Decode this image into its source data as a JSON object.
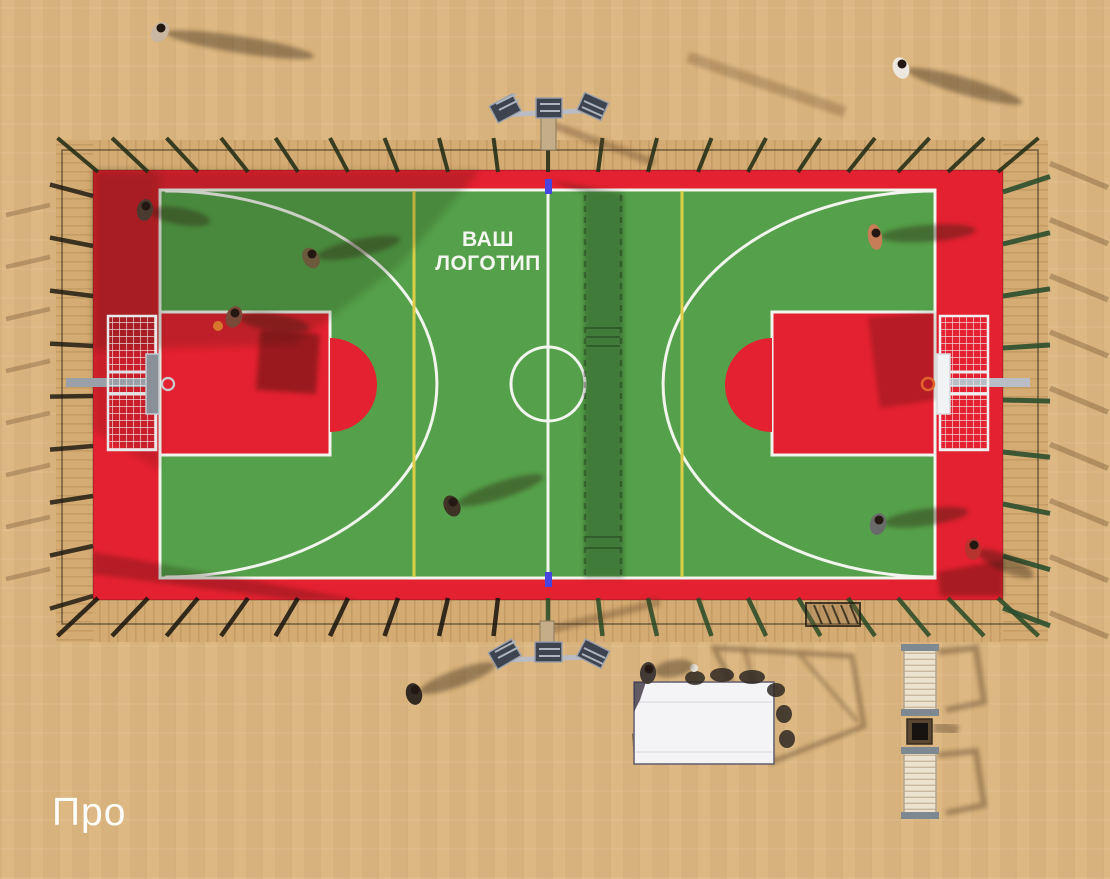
{
  "overlay": {
    "caption": "Про"
  },
  "court": {
    "logo_line1": "ВАШ",
    "logo_line2": "ЛОГОТИП"
  },
  "colors": {
    "sand": "#dcb67f",
    "wood": "#d4ab72",
    "plank_line": "#b98f5c",
    "court_red": "#e32130",
    "court_green": "#55a04a",
    "line_white": "#f2f4ee",
    "line_yellow": "#ddcf4a",
    "net_post_blue": "#4945e0",
    "fence_dark": "#17140e",
    "fence_green": "#2c4f2e",
    "rim_orange": "#e0632c",
    "ball_orange": "#d9772c",
    "bench_cream": "#ece2d0",
    "tent_white": "#f4f3f5",
    "shadow_brown": "#563a20"
  },
  "people": [
    {
      "x": 160,
      "y": 32,
      "rot": 35,
      "shirt": "#c9b7a2",
      "dir": 9,
      "len": 150
    },
    {
      "x": 901,
      "y": 68,
      "rot": -20,
      "shirt": "#ece8e0",
      "dir": 16,
      "len": 120
    },
    {
      "x": 145,
      "y": 210,
      "rot": 10,
      "shirt": "#4a3a30",
      "dir": 10,
      "len": 60
    },
    {
      "x": 311,
      "y": 258,
      "rot": -30,
      "shirt": "#6b5a3c",
      "dir": -12,
      "len": 85
    },
    {
      "x": 234,
      "y": 317,
      "rot": 20,
      "shirt": "#7a4a38",
      "dir": 8,
      "len": 70,
      "ball": true
    },
    {
      "x": 875,
      "y": 237,
      "rot": 80,
      "shirt": "#c77d55",
      "dir": -4,
      "len": 95,
      "wide": true
    },
    {
      "x": 452,
      "y": 506,
      "rot": -25,
      "shirt": "#3f3326",
      "dir": -18,
      "len": 90
    },
    {
      "x": 878,
      "y": 524,
      "rot": 15,
      "shirt": "#6a6a6a",
      "dir": -8,
      "len": 85
    },
    {
      "x": 973,
      "y": 549,
      "rot": 0,
      "shirt": "#b6332e",
      "dir": 24,
      "len": 60
    },
    {
      "x": 414,
      "y": 694,
      "rot": -15,
      "shirt": "#332a22",
      "dir": -20,
      "len": 80
    },
    {
      "x": 648,
      "y": 673,
      "rot": 5,
      "shirt": "#433a35",
      "dir": -10,
      "len": 40
    }
  ]
}
